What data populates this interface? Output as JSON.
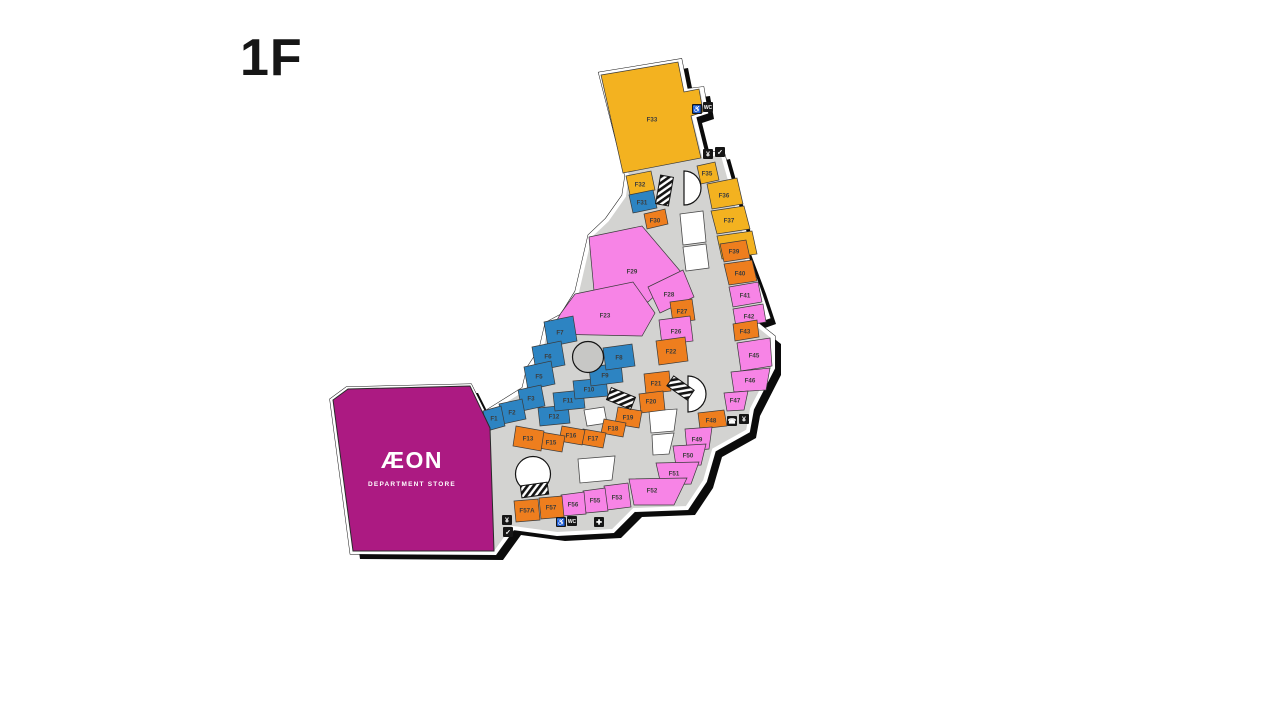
{
  "page": {
    "title": "1F"
  },
  "map": {
    "colors": {
      "yellow": "#F3B220",
      "orange": "#EE7E1E",
      "pink": "#F784E6",
      "blue": "#2D84C2",
      "magenta": "#AC1A82",
      "corridor": "#D3D3D1",
      "vacant": "#FFFFFF",
      "outline": "#141414",
      "label": "#3C3C3C"
    },
    "footprint": "M601,74 L680,61 L686,91 L702,89 L706,112 L694,116 L704,156 L722,152 L746,237 L741,242 L758,287 L768,317 L754,322 L773,337 L773,368 L752,409 L748,431 L714,450 L705,481 L687,508 L634,510 L613,531 L557,534 L513,528 L495,553 L352,552 L332,400 L347,389 L470,386 L484,414 L524,389 L529,368 L541,350 L547,324 L562,316 L577,292 L590,236 L607,220 L624,196 L627,176 Z",
    "anchor": {
      "name": "AEON Department Store",
      "logo": "ÆON",
      "sub": "DEPARTMENT STORE",
      "points": "333,400 348,389 470,386 490,428 494,551 353,551",
      "logo_x": 412,
      "logo_y": 468,
      "sub_x": 412,
      "sub_y": 486
    },
    "stores": [
      {
        "id": "F33",
        "cat": "yellow",
        "points": "601,75 678,62 684,92 699,89 703,112 691,116 701,158 623,173",
        "lx": 652,
        "ly": 120
      },
      {
        "id": "F32",
        "cat": "yellow",
        "points": "626,176 651,171 655,190 630,195",
        "lx": 640,
        "ly": 185
      },
      {
        "id": "F35",
        "cat": "yellow",
        "points": "697,166 715,162 719,180 701,184",
        "lx": 707,
        "ly": 174
      },
      {
        "id": "F36",
        "cat": "yellow",
        "points": "707,184 737,178 743,204 712,209",
        "lx": 724,
        "ly": 196
      },
      {
        "id": "F37",
        "cat": "yellow",
        "points": "711,211 744,206 750,229 717,234",
        "lx": 729,
        "ly": 221
      },
      {
        "id": "F38",
        "cat": "yellow",
        "points": "717,236 752,231 757,254 722,259",
        "lx": 735,
        "ly": 246
      },
      {
        "id": "F31",
        "cat": "blue",
        "points": "629,195 653,190 657,208 633,213",
        "lx": 642,
        "ly": 203
      },
      {
        "id": "F30",
        "cat": "orange",
        "points": "644,214 665,209 668,224 647,229",
        "lx": 655,
        "ly": 221
      },
      {
        "id": "F39",
        "cat": "orange",
        "points": "720,244 746,240 750,258 724,262",
        "lx": 734,
        "ly": 252
      },
      {
        "id": "F40",
        "cat": "orange",
        "points": "724,264 752,260 757,281 729,285",
        "lx": 740,
        "ly": 274
      },
      {
        "id": "F41",
        "cat": "pink",
        "points": "729,287 758,282 762,302 733,307",
        "lx": 745,
        "ly": 296
      },
      {
        "id": "F42",
        "cat": "pink",
        "points": "733,309 763,304 766,322 736,327",
        "lx": 749,
        "ly": 317
      },
      {
        "id": "F43",
        "cat": "orange",
        "points": "733,324 757,320 759,337 735,341",
        "lx": 745,
        "ly": 332
      },
      {
        "id": "F45",
        "cat": "pink",
        "points": "737,343 770,338 772,366 741,371",
        "lx": 754,
        "ly": 356
      },
      {
        "id": "F46",
        "cat": "pink",
        "points": "731,372 770,368 766,390 734,392",
        "lx": 750,
        "ly": 381
      },
      {
        "id": "F47",
        "cat": "pink",
        "points": "724,393 748,391 744,410 727,411",
        "lx": 735,
        "ly": 401
      },
      {
        "id": "F48",
        "cat": "orange",
        "points": "698,413 724,410 727,426 700,429",
        "lx": 711,
        "ly": 421
      },
      {
        "id": "F29",
        "cat": "pink",
        "points": "589,237 642,226 681,272 648,302 594,291",
        "lx": 632,
        "ly": 272
      },
      {
        "id": "F28",
        "cat": "pink",
        "points": "648,287 683,270 694,297 660,313",
        "lx": 669,
        "ly": 295
      },
      {
        "id": "F27",
        "cat": "orange",
        "points": "670,302 692,299 695,320 673,323",
        "lx": 682,
        "ly": 312
      },
      {
        "id": "F26",
        "cat": "pink",
        "points": "659,320 690,316 693,341 662,345",
        "lx": 676,
        "ly": 332
      },
      {
        "id": "F23",
        "cat": "pink",
        "points": "575,294 633,282 655,313 642,336 549,334 561,313",
        "lx": 605,
        "ly": 316
      },
      {
        "id": "F22",
        "cat": "orange",
        "points": "656,341 685,337 688,361 659,365",
        "lx": 671,
        "ly": 352
      },
      {
        "id": "F21",
        "cat": "orange",
        "points": "644,374 669,371 671,391 646,394",
        "lx": 656,
        "ly": 384
      },
      {
        "id": "F20",
        "cat": "orange",
        "points": "639,394 663,391 665,410 641,413",
        "lx": 651,
        "ly": 402
      },
      {
        "id": "F19",
        "cat": "orange",
        "points": "618,407 642,411 639,428 615,424",
        "lx": 628,
        "ly": 418
      },
      {
        "id": "F18",
        "cat": "orange",
        "points": "604,419 626,423 623,437 601,433",
        "lx": 613,
        "ly": 429
      },
      {
        "id": "F17",
        "cat": "orange",
        "points": "583,429 606,433 603,448 580,444",
        "lx": 593,
        "ly": 439
      },
      {
        "id": "F16",
        "cat": "orange",
        "points": "562,426 585,430 582,445 559,441",
        "lx": 571,
        "ly": 436
      },
      {
        "id": "F15",
        "cat": "orange",
        "points": "541,432 565,436 562,452 538,448",
        "lx": 551,
        "ly": 443
      },
      {
        "id": "F13",
        "cat": "orange",
        "points": "516,426 544,431 541,451 513,446",
        "lx": 528,
        "ly": 439
      },
      {
        "id": "F12",
        "cat": "blue",
        "points": "538,408 568,405 570,423 540,426",
        "lx": 554,
        "ly": 417
      },
      {
        "id": "F11",
        "cat": "blue",
        "points": "553,393 583,390 585,408 555,411",
        "lx": 568,
        "ly": 401
      },
      {
        "id": "F10",
        "cat": "blue",
        "points": "573,381 606,378 608,396 575,399",
        "lx": 589,
        "ly": 390
      },
      {
        "id": "F9",
        "cat": "blue",
        "points": "589,367 621,363 623,382 591,386",
        "lx": 605,
        "ly": 376
      },
      {
        "id": "F8",
        "cat": "blue",
        "points": "603,348 632,344 635,366 606,370",
        "lx": 619,
        "ly": 358
      },
      {
        "id": "F7",
        "cat": "blue",
        "points": "544,322 573,316 577,341 548,347",
        "lx": 560,
        "ly": 333
      },
      {
        "id": "F6",
        "cat": "blue",
        "points": "532,347 561,341 565,365 536,371",
        "lx": 548,
        "ly": 357
      },
      {
        "id": "F5",
        "cat": "blue",
        "points": "524,367 551,361 555,384 528,390",
        "lx": 539,
        "ly": 377
      },
      {
        "id": "F3",
        "cat": "blue",
        "points": "518,390 541,385 545,406 522,411",
        "lx": 531,
        "ly": 399
      },
      {
        "id": "F2",
        "cat": "blue",
        "points": "499,404 522,399 526,419 503,424",
        "lx": 512,
        "ly": 413
      },
      {
        "id": "F1",
        "cat": "blue",
        "points": "483,411 501,406 505,426 487,431",
        "lx": 494,
        "ly": 419
      },
      {
        "id": "F49",
        "cat": "pink",
        "points": "685,429 712,427 709,449 687,451",
        "lx": 697,
        "ly": 440
      },
      {
        "id": "F50",
        "cat": "pink",
        "points": "673,446 706,444 701,465 676,466",
        "lx": 688,
        "ly": 456
      },
      {
        "id": "F51",
        "cat": "pink",
        "points": "656,463 699,462 691,484 661,485",
        "lx": 674,
        "ly": 474
      },
      {
        "id": "F52",
        "cat": "pink",
        "points": "629,479 687,478 674,505 634,505",
        "lx": 652,
        "ly": 491
      },
      {
        "id": "F53",
        "cat": "pink",
        "points": "604,486 628,483 631,507 607,510",
        "lx": 617,
        "ly": 498
      },
      {
        "id": "F55",
        "cat": "pink",
        "points": "583,491 605,488 608,511 586,513",
        "lx": 595,
        "ly": 501
      },
      {
        "id": "F56",
        "cat": "pink",
        "points": "561,495 584,492 586,514 563,516",
        "lx": 573,
        "ly": 505
      },
      {
        "id": "F57",
        "cat": "orange",
        "points": "539,498 562,496 564,517 541,519",
        "lx": 551,
        "ly": 508
      },
      {
        "id": "F57A",
        "cat": "orange",
        "points": "514,501 538,499 540,520 516,522",
        "lx": 527,
        "ly": 511
      }
    ],
    "vacant_units": [
      {
        "points": "680,214 703,211 706,242 683,245"
      },
      {
        "points": "683,247 706,244 709,268 686,271"
      },
      {
        "points": "649,411 677,409 674,431 651,433"
      },
      {
        "points": "652,435 674,433 669,454 653,455"
      },
      {
        "points": "578,459 615,456 612,480 580,483"
      },
      {
        "points": "584,410 604,407 607,423 587,426"
      }
    ],
    "courts": [
      {
        "name": "atrium-court-top",
        "kind": "dpath",
        "d": "M 684 171 A 17 17 0 1 1 684 205 Z",
        "fill": "#FFFFFF"
      },
      {
        "name": "atrium-court-mid",
        "kind": "dpath",
        "d": "M 688 376 A 18 18 0 1 1 688 412 Z",
        "fill": "#FFFFFF"
      },
      {
        "name": "round-plaza",
        "kind": "circle",
        "cx": 588,
        "cy": 357,
        "r": 15.5,
        "fill": "#C7C7C5"
      },
      {
        "name": "event-dome",
        "kind": "circle",
        "cx": 533,
        "cy": 474,
        "r": 17.5,
        "fill": "#FFFFFF"
      }
    ],
    "escalators": [
      {
        "x": 658,
        "y": 176,
        "w": 13,
        "h": 29,
        "rot": 10
      },
      {
        "x": 608,
        "y": 392,
        "w": 26,
        "h": 13,
        "rot": 22
      },
      {
        "x": 668,
        "y": 382,
        "w": 25,
        "h": 12,
        "rot": 35
      },
      {
        "x": 521,
        "y": 484,
        "w": 27,
        "h": 12,
        "rot": -8
      }
    ],
    "icons": [
      {
        "name": "accessible-icon",
        "x": 692,
        "y": 104,
        "glyph": "♿",
        "fs": 7
      },
      {
        "name": "restroom-icon",
        "x": 703,
        "y": 102,
        "glyph": "WC",
        "fs": 5
      },
      {
        "name": "atm-icon",
        "x": 703,
        "y": 149,
        "glyph": "¥",
        "fs": 7
      },
      {
        "name": "service-icon",
        "x": 715,
        "y": 147,
        "glyph": "✓",
        "fs": 7
      },
      {
        "name": "phone-icon",
        "x": 727,
        "y": 416,
        "glyph": "☎",
        "fs": 7
      },
      {
        "name": "atm-icon",
        "x": 739,
        "y": 414,
        "glyph": "¥",
        "fs": 7
      },
      {
        "name": "accessible-icon",
        "x": 556,
        "y": 517,
        "glyph": "♿",
        "fs": 7
      },
      {
        "name": "restroom-icon",
        "x": 567,
        "y": 516,
        "glyph": "WC",
        "fs": 5
      },
      {
        "name": "first-aid-icon",
        "x": 594,
        "y": 517,
        "glyph": "✚",
        "fs": 7
      },
      {
        "name": "atm-icon",
        "x": 502,
        "y": 515,
        "glyph": "¥",
        "fs": 7
      },
      {
        "name": "service-icon",
        "x": 503,
        "y": 527,
        "glyph": "✓",
        "fs": 7
      }
    ]
  }
}
